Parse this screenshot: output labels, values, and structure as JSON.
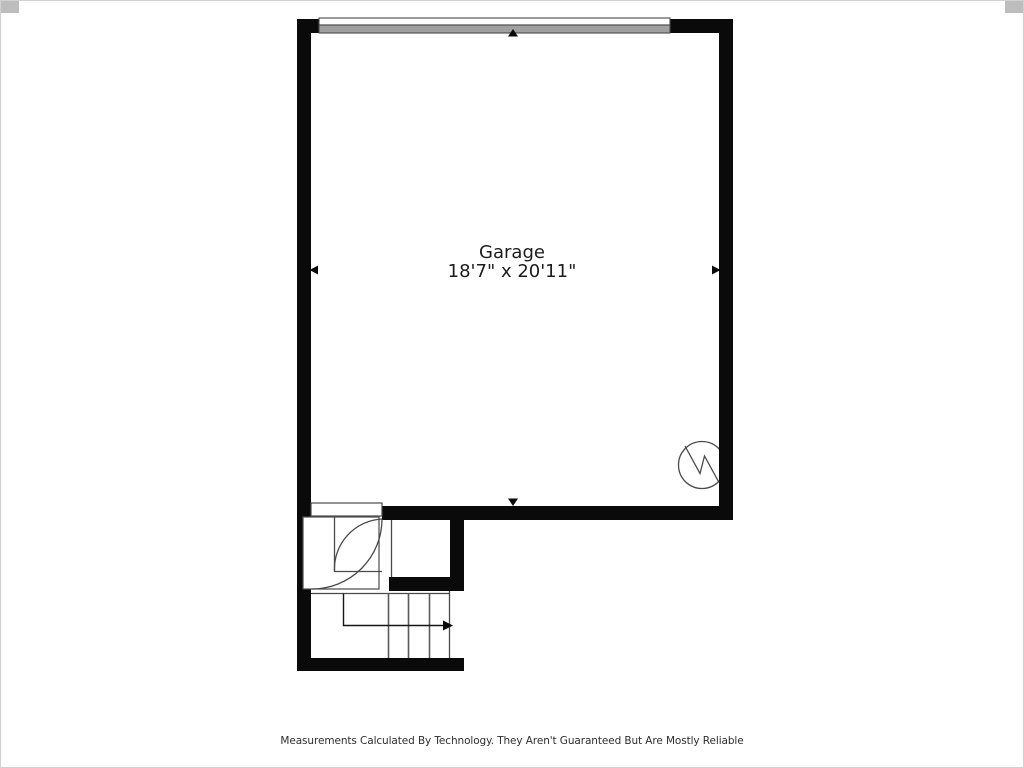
{
  "room": {
    "name": "Garage",
    "dimensions": "18'7\" x 20'11\""
  },
  "footer": {
    "disclaimer": "Measurements Calculated By Technology. They Aren't Guaranteed But Are Mostly Reliable"
  },
  "symbols": {
    "garage_door": "garage-door-icon",
    "water_heater": "water-heater-icon",
    "entry_door": "door-swing-icon",
    "stairs": "stairs-icon",
    "dimension_arrows": [
      "arrow-up-icon",
      "arrow-left-icon",
      "arrow-right-icon",
      "arrow-down-icon"
    ]
  },
  "colors": {
    "wall": "#0a0a0a",
    "garage_door": "#a0a0a0",
    "line": "#4a4a4a",
    "text": "#1c1c1c",
    "background": "#ffffff",
    "border": "#d2d2d2"
  }
}
